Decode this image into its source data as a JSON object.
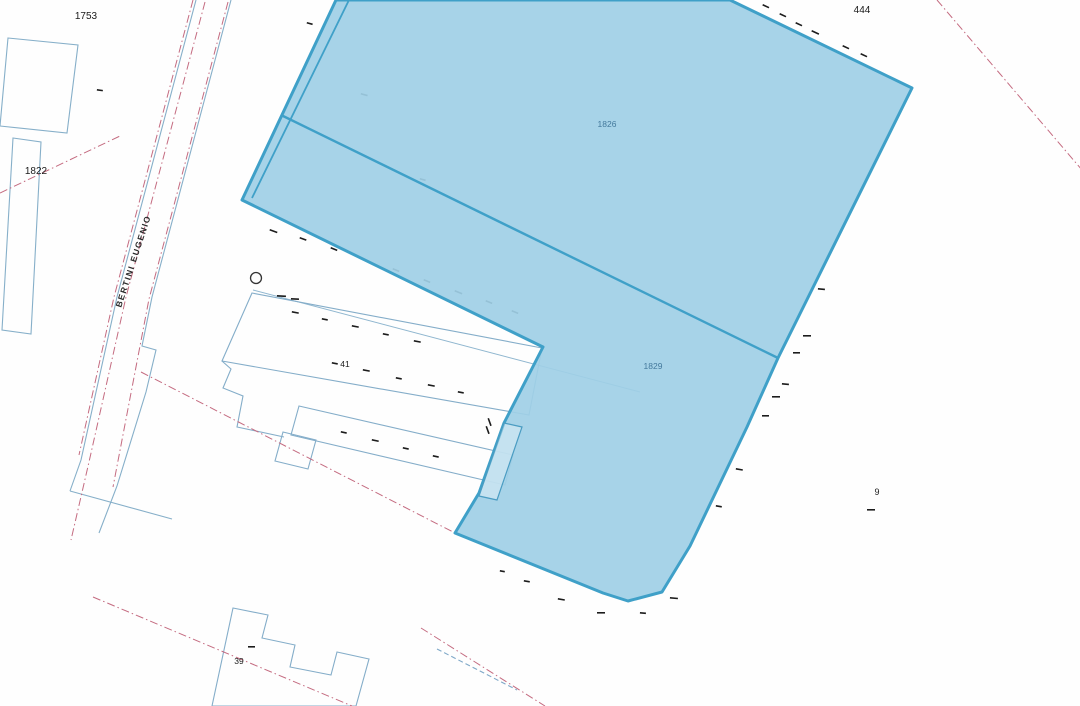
{
  "map": {
    "width": 1080,
    "height": 706,
    "background": "#fefefe",
    "colors": {
      "highlight_fill": "#9fcfe6",
      "highlight_stroke": "#3fa0c8",
      "parcel_line": "#86afc9",
      "boundary_red": "#c46b80",
      "tick": "#1c1c1c",
      "label_black": "#1a1a1a",
      "label_blue": "#44799c"
    },
    "base_lines": [
      {
        "name": "parcel-1753-outline",
        "d": "M8,38 L78,45 L67,133 L0,126 Z",
        "color": "#86afc9",
        "width": 1.1
      },
      {
        "name": "parcel-1822-outline",
        "d": "M13,138 L41,142 L31,334 L2,330 Z",
        "color": "#86afc9",
        "width": 1.1
      },
      {
        "name": "road-east-curb",
        "d": "M231,0 L152,297 L142,346 L156,350 L146,392 L117,486 L99,533",
        "color": "#86afc9",
        "width": 1.1
      },
      {
        "name": "road-west-curb",
        "d": "M196,0 L117,297 L81,460 L70,491",
        "color": "#86afc9",
        "width": 1.1
      },
      {
        "name": "lower-parcel-boundary",
        "d": "M70,491 L172,519",
        "color": "#86afc9",
        "width": 1.1
      },
      {
        "name": "parcel-41-front-line",
        "d": "M253,290 L640,392",
        "color": "#8fb6cf",
        "width": 1.0
      },
      {
        "name": "building-41-main-outline",
        "d": "M252,293 L542,348 L529,415 L222,361 Z",
        "color": "#84adc9",
        "width": 1.1
      },
      {
        "name": "building-41-steps-outline",
        "d": "M222,361 L231,369 L223,388 L243,396 L237,427 L284,437",
        "color": "#84adc9",
        "width": 1.1
      },
      {
        "name": "building-41-annex-outline",
        "d": "M299,406 L513,455 L505,485 L291,435 Z",
        "color": "#84adc9",
        "width": 1.1
      },
      {
        "name": "building-41-small-wing-outline",
        "d": "M283,432 L316,440 L308,469 L275,461 Z",
        "color": "#84adc9",
        "width": 1.1
      },
      {
        "name": "building-39-outline",
        "d": "M233,608 L268,615 L262,638 L295,645 L290,667 L331,675 L337,652 L369,659 L356,706 L212,706 Z",
        "color": "#84adc9",
        "width": 1.1
      },
      {
        "name": "utility-dashed-line",
        "d": "M437,649 L517,690",
        "color": "#7fa8c8",
        "width": 1.1,
        "dash": "5 3"
      },
      {
        "name": "boundary-red-road-center",
        "d": "M205,2 L126,297 L89,462 L71,540",
        "color": "#c46b80",
        "width": 1.0,
        "dash": "8 3 1.5 3"
      },
      {
        "name": "boundary-red-road-east",
        "d": "M228,2 L149,299 L113,487",
        "color": "#c46b80",
        "width": 1.0,
        "dash": "8 3 1.5 3"
      },
      {
        "name": "boundary-red-road-west",
        "d": "M193,0 L114,297 L79,455",
        "color": "#c46b80",
        "width": 1.0,
        "dash": "8 3 1.5 3"
      },
      {
        "name": "boundary-red-1822",
        "d": "M0,193 L120,136",
        "color": "#c46b80",
        "width": 1.0,
        "dash": "8 3 1.5 3"
      },
      {
        "name": "boundary-red-mid",
        "d": "M141,372 L455,533",
        "color": "#c46b80",
        "width": 1.0,
        "dash": "8 3 1.5 3"
      },
      {
        "name": "boundary-red-bottom-left",
        "d": "M93,597 L352,706",
        "color": "#c46b80",
        "width": 1.0,
        "dash": "8 3 1.5 3"
      },
      {
        "name": "boundary-red-bottom-mid",
        "d": "M421,628 L545,706",
        "color": "#c46b80",
        "width": 1.0,
        "dash": "8 3 1.5 3"
      },
      {
        "name": "boundary-red-top-right",
        "d": "M937,0 L1082,170",
        "color": "#c46b80",
        "width": 1.0,
        "dash": "8 3 1.5 3"
      }
    ],
    "ticks": [
      [
        763,
        4,
        7,
        25
      ],
      [
        780,
        13,
        7,
        25
      ],
      [
        796,
        22,
        7,
        25
      ],
      [
        812,
        30,
        8,
        25
      ],
      [
        843,
        45,
        7,
        25
      ],
      [
        861,
        53,
        7,
        25
      ],
      [
        818,
        288,
        7,
        5
      ],
      [
        803,
        335,
        8,
        0
      ],
      [
        793,
        352,
        7,
        0
      ],
      [
        782,
        383,
        7,
        5
      ],
      [
        772,
        396,
        8,
        0
      ],
      [
        762,
        415,
        7,
        0
      ],
      [
        736,
        468,
        7,
        10
      ],
      [
        716,
        505,
        6,
        10
      ],
      [
        670,
        597,
        8,
        5
      ],
      [
        640,
        612,
        6,
        5
      ],
      [
        597,
        612,
        8,
        0
      ],
      [
        558,
        598,
        7,
        10
      ],
      [
        524,
        580,
        6,
        10
      ],
      [
        500,
        570,
        5,
        10
      ],
      [
        270,
        229,
        8,
        20
      ],
      [
        300,
        237,
        7,
        20
      ],
      [
        331,
        247,
        7,
        22
      ],
      [
        362,
        258,
        8,
        22
      ],
      [
        393,
        268,
        7,
        22
      ],
      [
        424,
        279,
        7,
        22
      ],
      [
        455,
        290,
        8,
        22
      ],
      [
        486,
        300,
        7,
        22
      ],
      [
        512,
        310,
        7,
        22
      ],
      [
        292,
        311,
        7,
        11
      ],
      [
        322,
        318,
        6,
        11
      ],
      [
        352,
        325,
        7,
        11
      ],
      [
        383,
        333,
        6,
        11
      ],
      [
        414,
        340,
        7,
        11
      ],
      [
        332,
        362,
        6,
        11
      ],
      [
        363,
        369,
        7,
        11
      ],
      [
        396,
        377,
        6,
        11
      ],
      [
        428,
        384,
        7,
        11
      ],
      [
        458,
        391,
        6,
        11
      ],
      [
        341,
        431,
        6,
        12
      ],
      [
        372,
        439,
        7,
        12
      ],
      [
        403,
        447,
        6,
        12
      ],
      [
        433,
        455,
        6,
        12
      ],
      [
        867,
        509,
        8,
        0
      ],
      [
        248,
        646,
        7,
        0
      ],
      [
        97,
        89,
        6,
        8
      ],
      [
        361,
        93,
        7,
        15
      ],
      [
        307,
        22,
        6,
        15
      ],
      [
        420,
        178,
        6,
        15
      ],
      [
        277,
        295,
        9,
        3
      ],
      [
        291,
        298,
        8,
        3
      ],
      [
        489,
        418,
        8,
        70
      ],
      [
        487,
        426,
        8,
        70
      ]
    ],
    "circles": [
      {
        "name": "survey-point-circle",
        "x": 256,
        "y": 278,
        "r": 5.5,
        "color": "#333333"
      }
    ],
    "highlight": {
      "name": "selected-parcels",
      "outline_points": "336,0 730,0 912,88 778,358 747,427 690,546 662,592 628,601 603,593 455,533 479,493 504,423 543,347 242,200",
      "fill": "#9fcfe6",
      "fill_opacity": 0.92,
      "stroke": "#3fa0c8",
      "stroke_width": 3,
      "inner_lines": [
        {
          "name": "parcel-divider-1826-1829",
          "d": "M281,115 L778,358",
          "width": 2.4
        },
        {
          "name": "parcel-strip-line",
          "d": "M349,0 L252,198",
          "width": 1.8
        }
      ],
      "overlays": [
        {
          "name": "building-41-sliver-annex",
          "d": "M504,423 L522,427 L497,500 L479,496 Z",
          "stroke": "#4a9cc2",
          "width": 1.2,
          "fill": "rgba(255,255,255,0.35)"
        }
      ]
    },
    "labels": [
      {
        "name": "label-parcel-1753",
        "text": "1753",
        "x": 86,
        "y": 19,
        "size": 10,
        "color": "#1a1a1a"
      },
      {
        "name": "label-parcel-444",
        "text": "444",
        "x": 862,
        "y": 13,
        "size": 10,
        "color": "#1a1a1a"
      },
      {
        "name": "label-parcel-1822",
        "text": "1822",
        "x": 36,
        "y": 174,
        "size": 10,
        "color": "#1a1a1a"
      },
      {
        "name": "label-parcel-1826",
        "text": "1826",
        "x": 607,
        "y": 127,
        "size": 8.5,
        "color": "#44799c"
      },
      {
        "name": "label-parcel-1829",
        "text": "1829",
        "x": 653,
        "y": 369,
        "size": 8.5,
        "color": "#44799c"
      },
      {
        "name": "label-building-41",
        "text": "41",
        "x": 345,
        "y": 367,
        "size": 8.5,
        "color": "#1a1a1a"
      },
      {
        "name": "label-parcel-9",
        "text": "9",
        "x": 877,
        "y": 495,
        "size": 9,
        "color": "#1a1a1a"
      },
      {
        "name": "label-building-39",
        "text": "39",
        "x": 239,
        "y": 664,
        "size": 8.5,
        "color": "#1a1a1a"
      },
      {
        "name": "label-street-bertini-eugenio",
        "text": "BERTINI EUGENIO",
        "x": 136,
        "y": 262,
        "size": 8.5,
        "color": "#2a2a2a",
        "rotation": -72,
        "spacing": 1.4,
        "bold": true
      }
    ]
  }
}
